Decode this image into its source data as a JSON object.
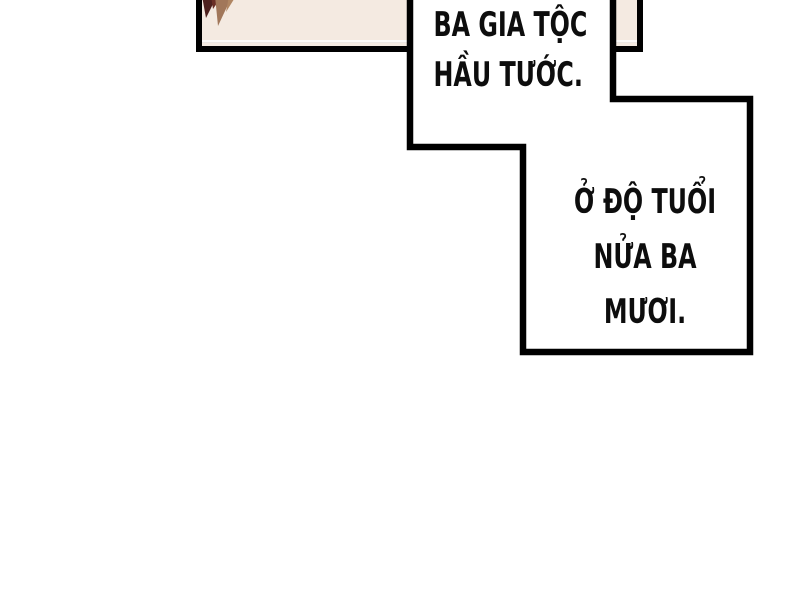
{
  "comic": {
    "bubble1": {
      "line1": "BA GIA TỘC",
      "line2": "HẦU TƯỚC."
    },
    "bubble2": {
      "line1": "Ở ĐỘ TUỔI",
      "line2": "NỬA BA",
      "line3": "MƯƠI."
    },
    "colors": {
      "page_bg": "#ffffff",
      "panel_bg": "#f4eae1",
      "outline": "#000000",
      "text": "#0d0d0d",
      "hair_dark": "#4e211e",
      "hair_mid": "#7a3a2c",
      "hair_light": "#a1775a"
    }
  }
}
